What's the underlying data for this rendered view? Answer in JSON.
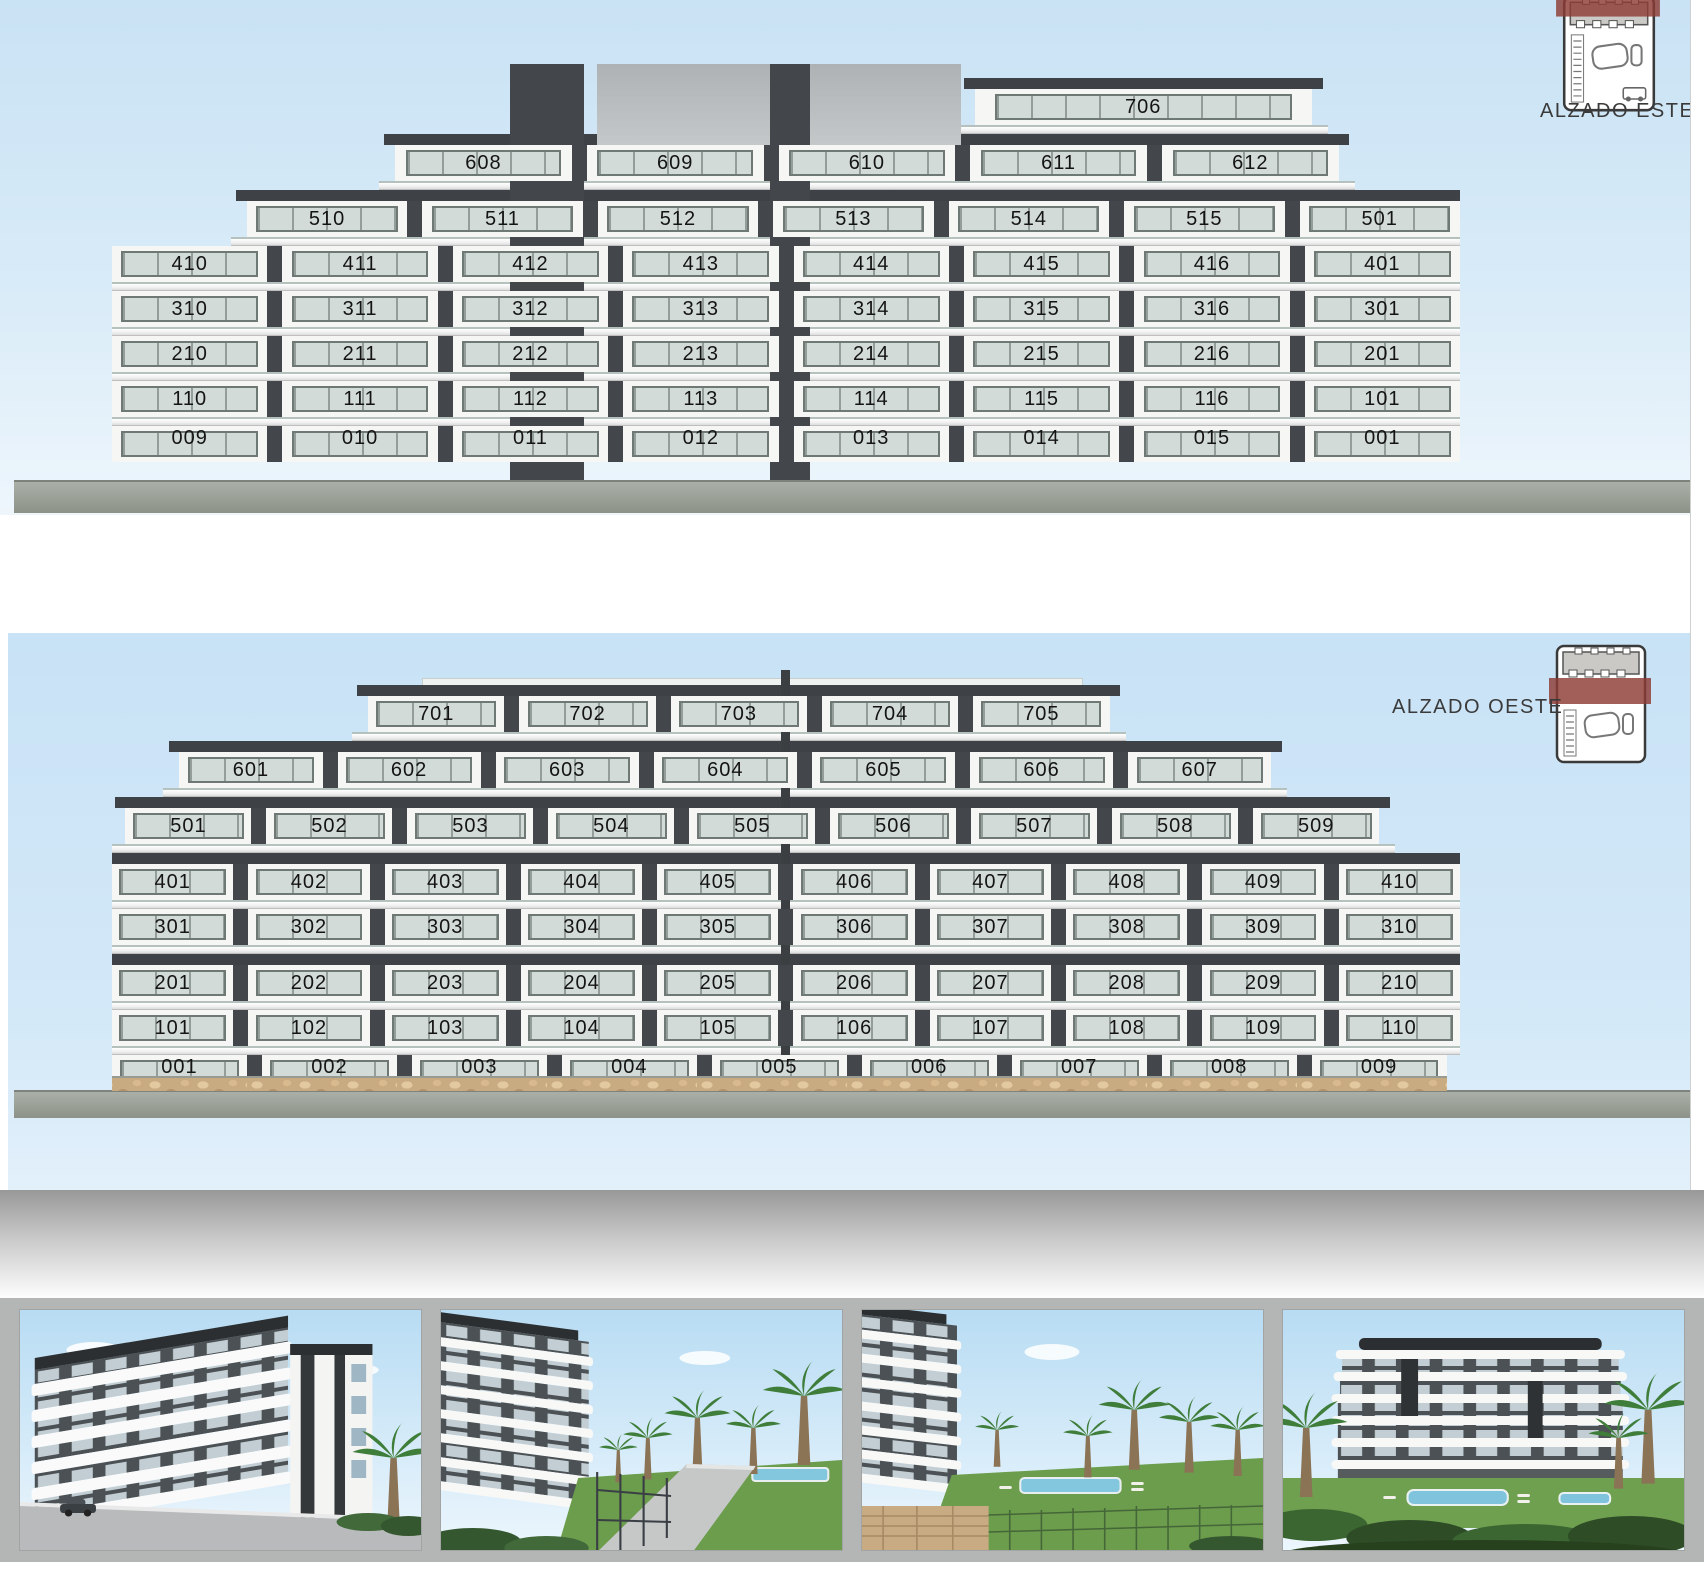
{
  "sheet": {
    "type": "architectural-elevations",
    "colors": {
      "sky": "#c9e2f4",
      "facade_dark": "#3e4246",
      "facade_white": "#f7f7f6",
      "window_glass": "#d2dbd7",
      "stone_wall": "#c9ab81",
      "key_highlight_red": "#8e3c35",
      "ground_strip": "#999e95",
      "photo_strip_bg": "#b4b5b5"
    }
  },
  "elevations": [
    {
      "id": "este",
      "key_label": "ALZADO ESTE",
      "key_icon": "site-plan-key-east-icon",
      "floors": [
        {
          "name": "floor-7",
          "roof": true,
          "left": 64,
          "right": 11,
          "units": [
            "706"
          ]
        },
        {
          "name": "floor-6",
          "roof": true,
          "left": 21,
          "right": 9,
          "units": [
            "608",
            "609",
            "610",
            "611",
            "612"
          ]
        },
        {
          "name": "floor-5",
          "roof": true,
          "left": 10,
          "right": 0,
          "units": [
            "510",
            "511",
            "512",
            "513",
            "514",
            "515",
            "501"
          ]
        },
        {
          "name": "floor-4",
          "roof": false,
          "left": 0,
          "right": 0,
          "units": [
            "410",
            "411",
            "412",
            "413",
            "414",
            "415",
            "416",
            "401"
          ]
        },
        {
          "name": "floor-3",
          "roof": false,
          "left": 0,
          "right": 0,
          "units": [
            "310",
            "311",
            "312",
            "313",
            "314",
            "315",
            "316",
            "301"
          ]
        },
        {
          "name": "floor-2",
          "roof": false,
          "left": 0,
          "right": 0,
          "units": [
            "210",
            "211",
            "212",
            "213",
            "214",
            "215",
            "216",
            "201"
          ]
        },
        {
          "name": "floor-1",
          "roof": false,
          "left": 0,
          "right": 0,
          "units": [
            "110",
            "111",
            "112",
            "113",
            "114",
            "115",
            "116",
            "101"
          ]
        },
        {
          "name": "floor-0",
          "roof": false,
          "ground": true,
          "left": 0,
          "right": 0,
          "units": [
            "009",
            "010",
            "011",
            "012",
            "013",
            "014",
            "015",
            "001"
          ]
        }
      ]
    },
    {
      "id": "oeste",
      "key_label": "ALZADO OESTE",
      "key_icon": "site-plan-key-west-icon",
      "floors": [
        {
          "name": "floor-7",
          "roof": true,
          "left": 19,
          "right": 26,
          "units": [
            "701",
            "702",
            "703",
            "704",
            "705"
          ]
        },
        {
          "name": "floor-6",
          "roof": true,
          "left": 5,
          "right": 14,
          "units": [
            "601",
            "602",
            "603",
            "604",
            "605",
            "606",
            "607"
          ]
        },
        {
          "name": "floor-5",
          "roof": true,
          "left": 1,
          "right": 6,
          "units": [
            "501",
            "502",
            "503",
            "504",
            "505",
            "506",
            "507",
            "508",
            "509"
          ]
        },
        {
          "name": "floor-4",
          "roof": true,
          "left": 0,
          "right": 0,
          "units": [
            "401",
            "402",
            "403",
            "404",
            "405",
            "406",
            "407",
            "408",
            "409",
            "410"
          ]
        },
        {
          "name": "floor-3",
          "roof": false,
          "left": 0,
          "right": 0,
          "units": [
            "301",
            "302",
            "303",
            "304",
            "305",
            "306",
            "307",
            "308",
            "309",
            "310"
          ]
        },
        {
          "name": "floor-2",
          "roof": true,
          "left": 0,
          "right": 0,
          "units": [
            "201",
            "202",
            "203",
            "204",
            "205",
            "206",
            "207",
            "208",
            "209",
            "210"
          ]
        },
        {
          "name": "floor-1",
          "roof": false,
          "left": 0,
          "right": 0,
          "units": [
            "101",
            "102",
            "103",
            "104",
            "105",
            "106",
            "107",
            "108",
            "109",
            "110"
          ]
        },
        {
          "name": "floor-0",
          "roof": false,
          "ground": true,
          "left": 0,
          "right": 1,
          "units": [
            "001",
            "002",
            "003",
            "004",
            "005",
            "006",
            "007",
            "008",
            "009"
          ]
        }
      ]
    }
  ],
  "photos": [
    {
      "name": "render-corner-street-view"
    },
    {
      "name": "render-walkway-pool-view"
    },
    {
      "name": "render-garden-pool-view"
    },
    {
      "name": "render-panoramic-garden-view"
    }
  ]
}
